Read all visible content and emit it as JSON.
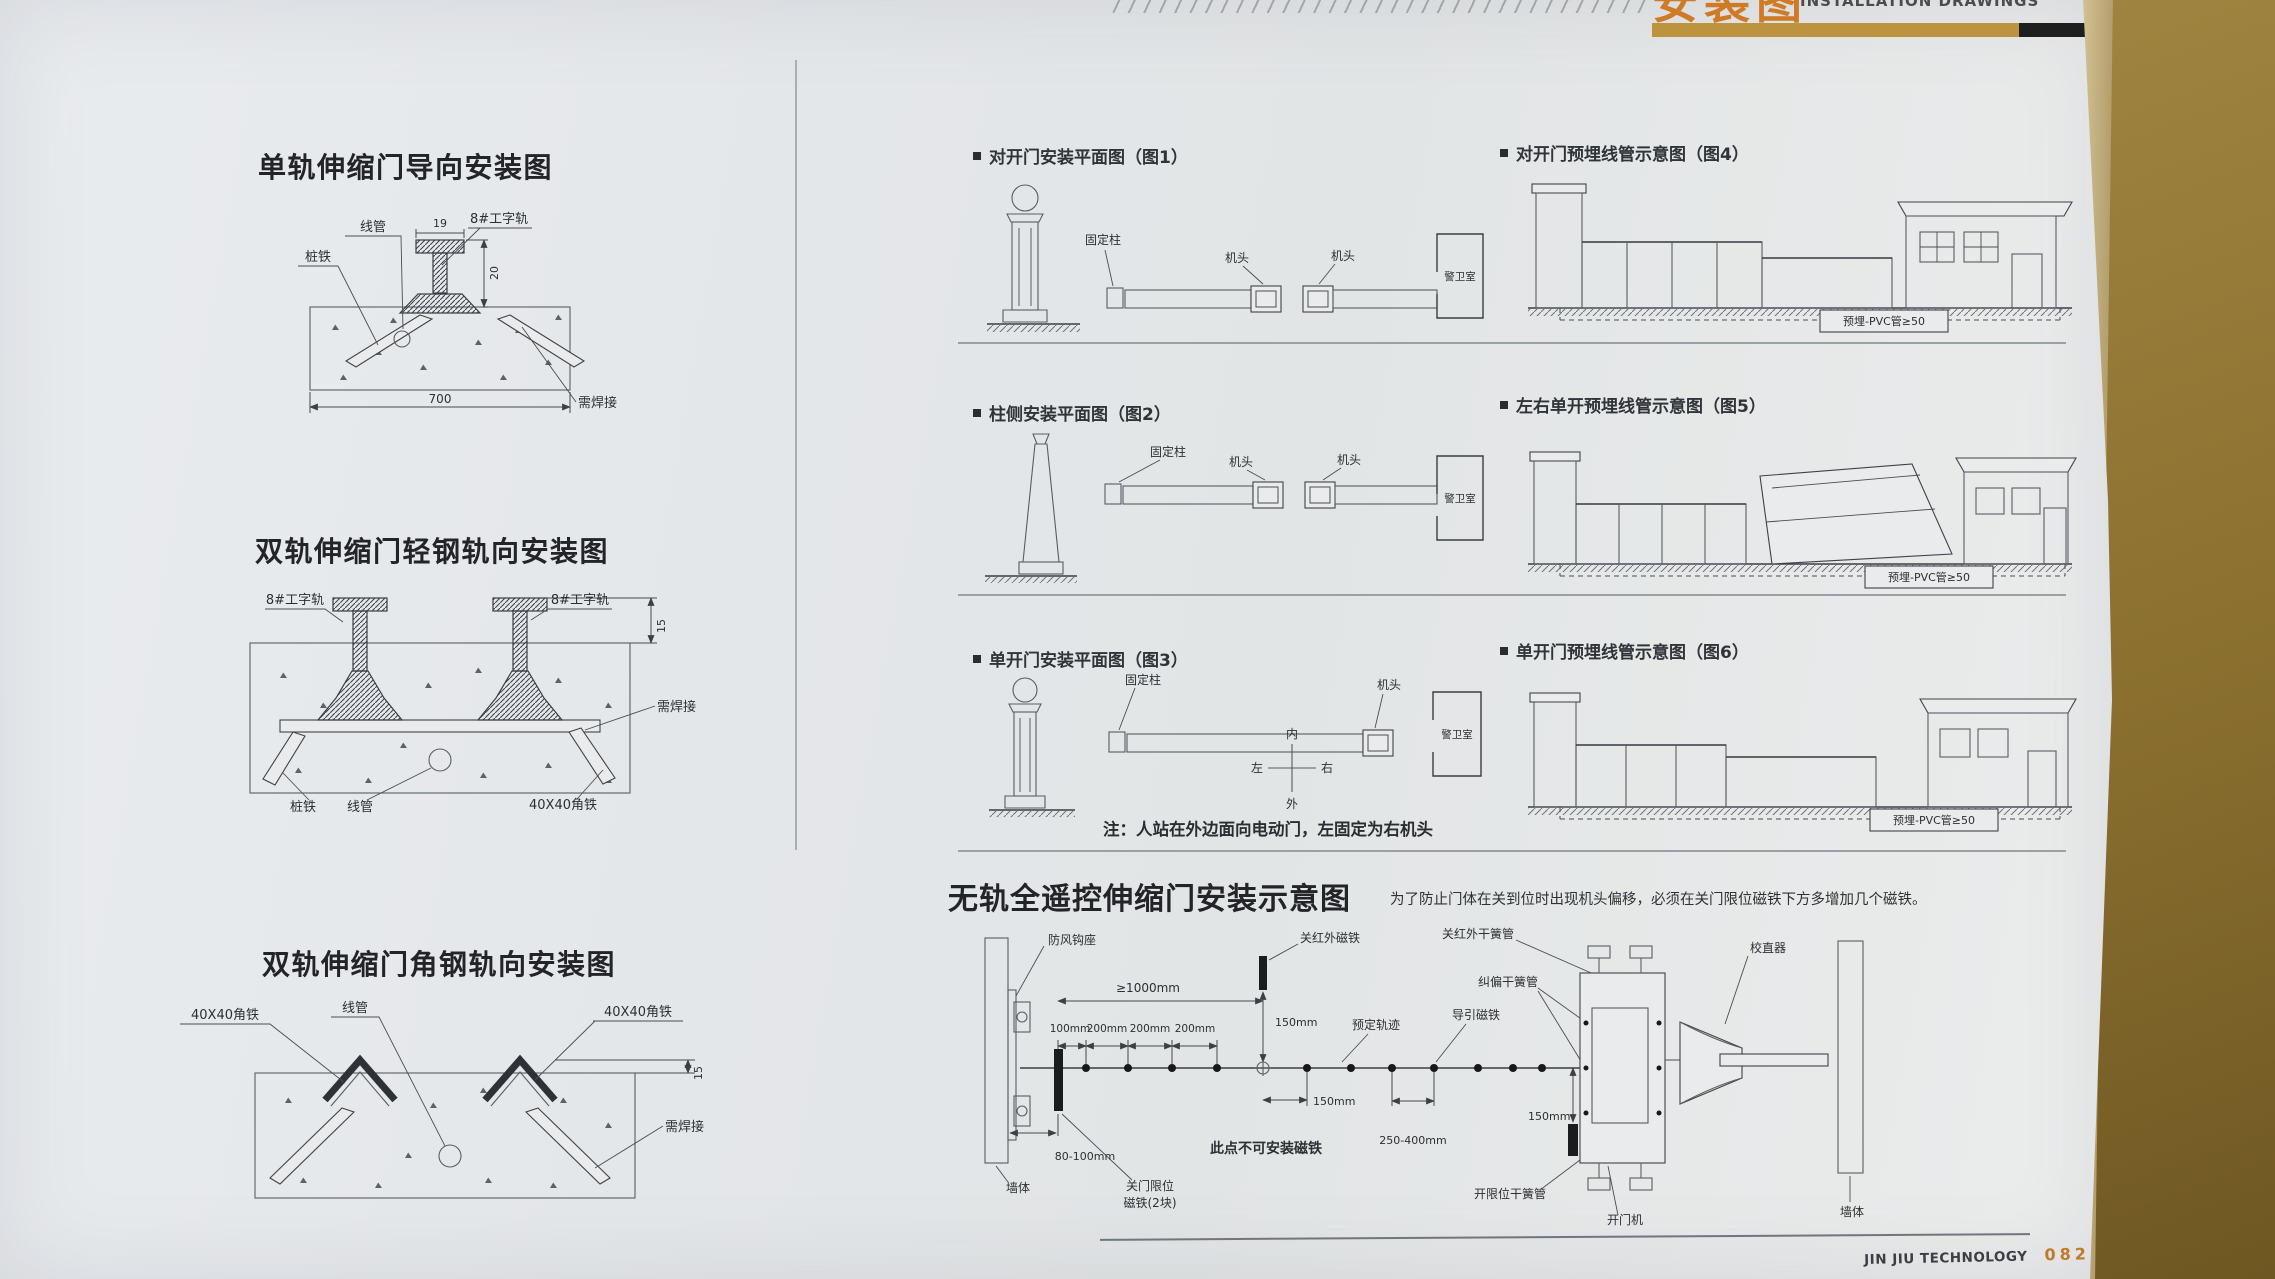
{
  "header": {
    "title_cn": "安装图",
    "title_en": "INSTALLATION DRAWINGS"
  },
  "colors": {
    "accent_gold": "#bd9340",
    "accent_orange": "#cf7a24",
    "page_number_orange": "#c07a28",
    "table_brown": "#9a7d3f",
    "page_bg": "#e7e9eb"
  },
  "left": {
    "d1": {
      "title": "单轨伸缩门导向安装图",
      "lbl_conduit": "线管",
      "lbl_pile": "桩铁",
      "lbl_rail": "8#工字轨",
      "lbl_weld": "需焊接",
      "dim_19": "19",
      "dim_20": "20",
      "dim_700": "700"
    },
    "d2": {
      "title": "双轨伸缩门轻钢轨向安装图",
      "lbl_rail": "8#工字轨",
      "dim_15": "15",
      "lbl_weld": "需焊接",
      "lbl_pile": "桩铁",
      "lbl_conduit": "线管",
      "lbl_angle": "40X40角铁"
    },
    "d3": {
      "title": "双轨伸缩门角钢轨向安装图",
      "lbl_conduit": "线管",
      "lbl_angle": "40X40角铁",
      "dim_15": "15",
      "lbl_weld": "需焊接"
    }
  },
  "figs": {
    "f1": {
      "caption": "对开门安装平面图（图1）",
      "lbl_post": "固定柱",
      "lbl_head": "机头",
      "lbl_room": "警卫室"
    },
    "f4": {
      "caption": "对开门预埋线管示意图（图4）",
      "lbl_pvc": "预埋-PVC管≥50"
    },
    "f2": {
      "caption": "柱侧安装平面图（图2）",
      "lbl_post": "固定柱",
      "lbl_head": "机头",
      "lbl_room": "警卫室"
    },
    "f5": {
      "caption": "左右单开预埋线管示意图（图5）",
      "lbl_pvc": "预埋-PVC管≥50"
    },
    "f3": {
      "caption": "单开门安装平面图（图3）",
      "lbl_post": "固定柱",
      "lbl_head": "机头",
      "lbl_room": "警卫室",
      "dir_in": "内",
      "dir_out": "外",
      "dir_left": "左",
      "dir_right": "右",
      "note": "注：人站在外边面向电动门，左固定为右机头"
    },
    "f6": {
      "caption": "单开门预埋线管示意图（图6）",
      "lbl_pvc": "预埋-PVC管≥50"
    }
  },
  "trackless": {
    "title": "无轨全遥控伸缩门安装示意图",
    "note": "为了防止门体在关到位时出现机头偏移，必须在关门限位磁铁下方多增加几个磁铁。",
    "lbl_wall": "墙体",
    "lbl_hook": "防风钩座",
    "dim_1000": "≥1000mm",
    "dim_100": "100mm",
    "dim_200": "200mm",
    "dim_150": "150mm",
    "dim_250": "250-400mm",
    "dim_80": "80-100mm",
    "lbl_close_ir_magnet": "关红外磁铁",
    "lbl_close_ir_reed": "关红外干簧管",
    "lbl_correct_reed": "纠偏干簧管",
    "lbl_guide_magnet": "导引磁铁",
    "lbl_track": "预定轨迹",
    "lbl_limit_magnet_1": "关门限位",
    "lbl_limit_magnet_2": "磁铁(2块)",
    "lbl_no_magnet": "此点不可安装磁铁",
    "lbl_open_reed": "开限位干簧管",
    "lbl_opener": "开门机",
    "lbl_straightener": "校直器"
  },
  "footer": {
    "brand": "JIN JIU TECHNOLOGY",
    "page_no": "082"
  }
}
